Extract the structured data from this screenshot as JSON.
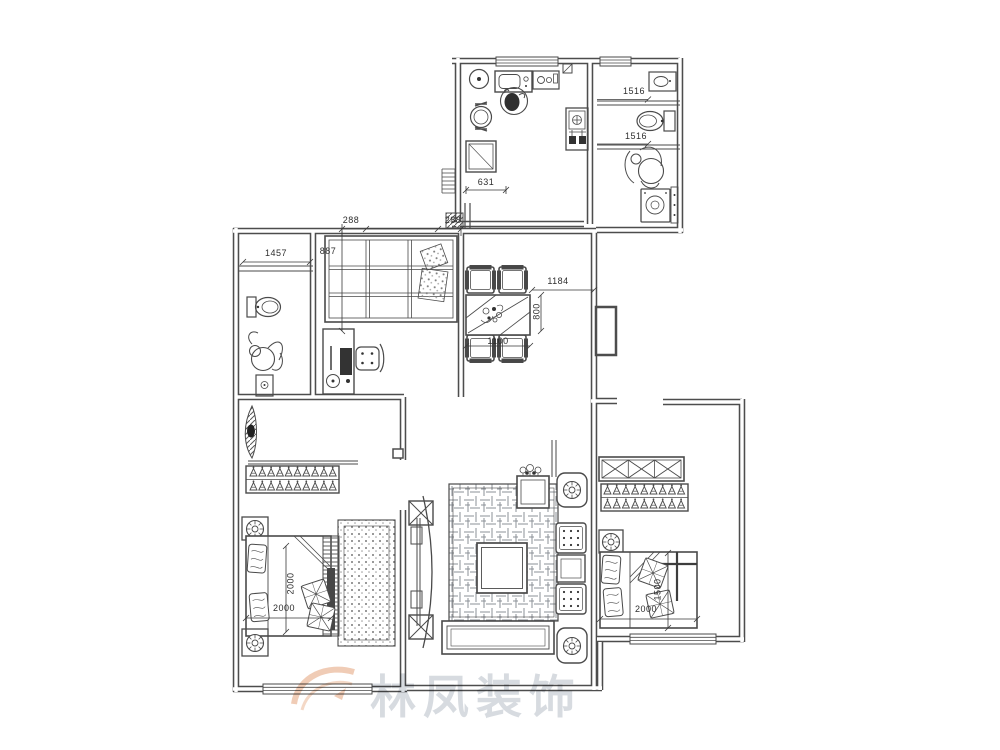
{
  "dims": {
    "kitchen_door": "631",
    "bath_top_upper": "1516",
    "bath_top_lower": "1516",
    "bath_mid_width": "1457",
    "study_pier_left": "288",
    "study_pier_right": "288",
    "wardrobe_depth": "887",
    "dining_width": "1184",
    "dining_clearance": "800",
    "dining_table": "1100",
    "bed_left_length_vertical": "2000",
    "bed_left_length_horizontal": "2000",
    "bed_right_width": "1500",
    "bed_right_length": "2000"
  },
  "watermark": {
    "brand": "林凤装饰",
    "logo_color": "#dd8c5a"
  },
  "colors": {
    "line": "#4a4a4a",
    "wall": "#4d4d4d",
    "dim_text": "#2e2e2e",
    "background": "#ffffff"
  }
}
